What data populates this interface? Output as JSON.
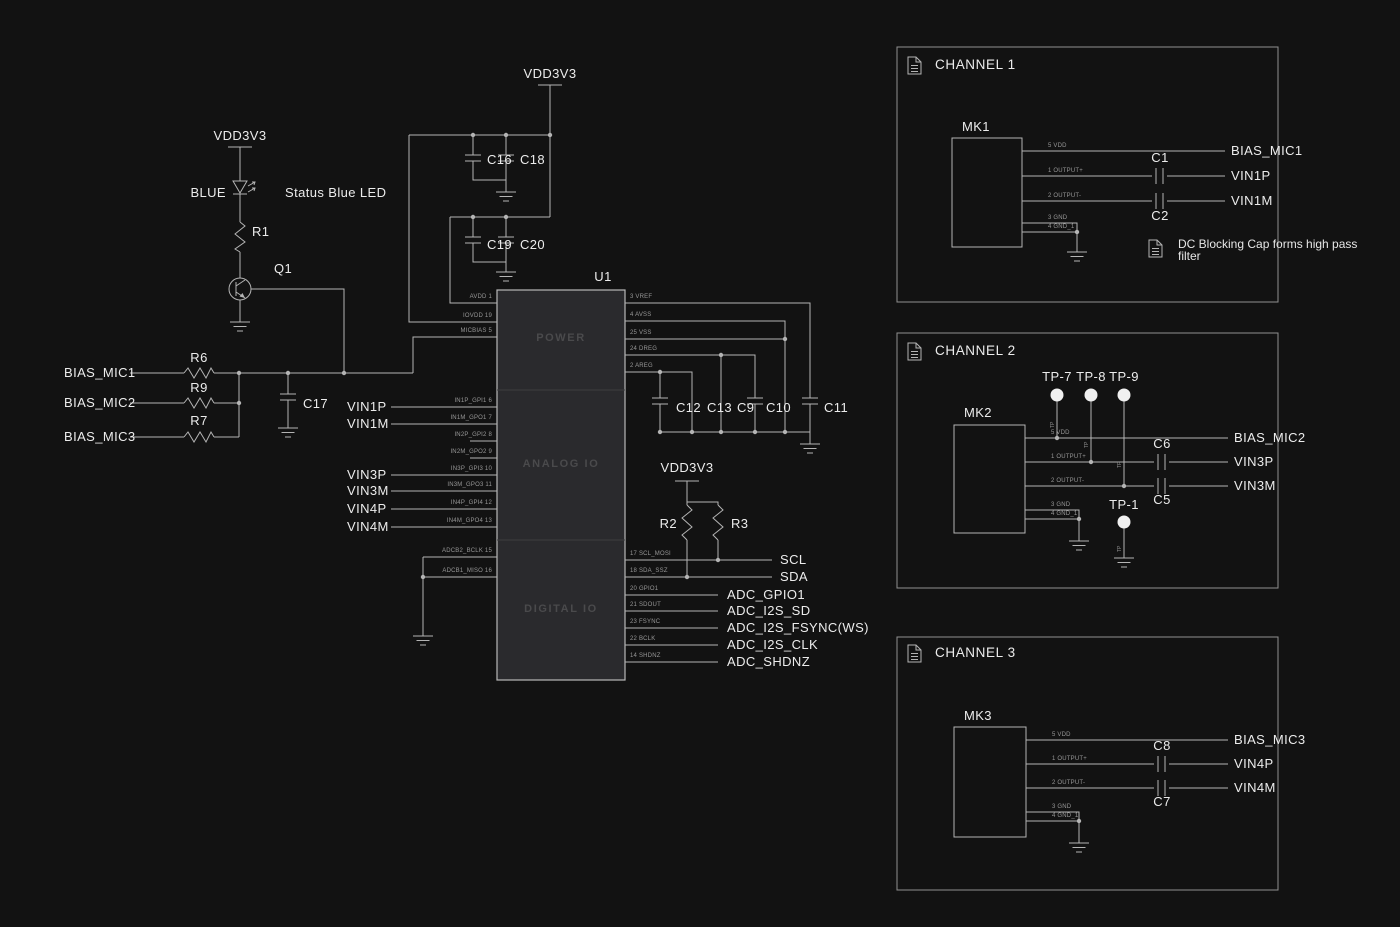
{
  "colors": {
    "background": "#121212",
    "wire": "#b4b4b4",
    "text": "#ececec",
    "dim_text": "#979797",
    "chip_fill": "#2a2a2d",
    "chip_border": "#b8b8b8",
    "section_text": "#4a4a4c",
    "panel_border": "#909090",
    "testpoint_fill": "#f0f0f0"
  },
  "main": {
    "vdd": "VDD3V3",
    "led": {
      "net": "BLUE",
      "note": "Status Blue LED",
      "ref": "R1",
      "q": "Q1"
    },
    "bias": {
      "m1": "BIAS_MIC1",
      "m2": "BIAS_MIC2",
      "m3": "BIAS_MIC3",
      "r6": "R6",
      "r9": "R9",
      "r7": "R7",
      "c17": "C17"
    },
    "topcaps": {
      "c16": "C16",
      "c18": "C18",
      "c19": "C19",
      "c20": "C20"
    },
    "u1": {
      "ref": "U1",
      "sections": [
        "POWER",
        "ANALOG IO",
        "DIGITAL IO"
      ],
      "lpins": [
        "AVDD 1",
        "IOVDD 19",
        "MICBIAS 5",
        "IN1P_GPI1 6",
        "IN1M_GPO1 7",
        "IN2P_GPI2 8",
        "IN2M_GPO2 9",
        "IN3P_GPI3 10",
        "IN3M_GPO3 11",
        "IN4P_GPI4 12",
        "IN4M_GPO4 13",
        "ADCB2_BCLK 15",
        "ADCB1_MISO 16"
      ],
      "rpins": [
        "3 VREF",
        "4 AVSS",
        "25 VSS",
        "24 DREG",
        "2 AREG",
        "17 SCL_MOSI",
        "18 SDA_SSZ",
        "20 GPIO1",
        "21 SDOUT",
        "23 FSYNC",
        "22 BCLK",
        "14 SHDNZ"
      ]
    },
    "vins": [
      "VIN1P",
      "VIN1M",
      "VIN3P",
      "VIN3M",
      "VIN4P",
      "VIN4M"
    ],
    "rightcaps": [
      "C12",
      "C13",
      "C9",
      "C10",
      "C11"
    ],
    "i2c": {
      "r2": "R2",
      "r3": "R3",
      "scl": "SCL",
      "sda": "SDA"
    },
    "dig": [
      "ADC_GPIO1",
      "ADC_I2S_SD",
      "ADC_I2S_FSYNC(WS)",
      "ADC_I2S_CLK",
      "ADC_SHDNZ"
    ]
  },
  "channels": [
    {
      "title": "CHANNEL 1",
      "mic": "MK1",
      "pins": [
        "5 VDD",
        "1 OUTPUT+",
        "2 OUTPUT-",
        "3 GND",
        "4 GND_1"
      ],
      "ctop": "C1",
      "cbot": "C2",
      "bias": "BIAS_MIC1",
      "vp": "VIN1P",
      "vm": "VIN1M",
      "note1": "DC Blocking Cap forms high pass",
      "note2": "filter"
    },
    {
      "title": "CHANNEL 2",
      "mic": "MK2",
      "pins": [
        "5 VDD",
        "1 OUTPUT+",
        "2 OUTPUT-",
        "3 GND",
        "4 GND_1"
      ],
      "ctop": "C6",
      "cbot": "C5",
      "bias": "BIAS_MIC2",
      "vp": "VIN3P",
      "vm": "VIN3M",
      "tps": [
        "TP-7",
        "TP-8",
        "TP-9"
      ],
      "tpg": "TP-1",
      "tpmark": "TP"
    },
    {
      "title": "CHANNEL 3",
      "mic": "MK3",
      "pins": [
        "5 VDD",
        "1 OUTPUT+",
        "2 OUTPUT-",
        "3 GND",
        "4 GND_1"
      ],
      "ctop": "C8",
      "cbot": "C7",
      "bias": "BIAS_MIC3",
      "vp": "VIN4P",
      "vm": "VIN4M"
    }
  ]
}
